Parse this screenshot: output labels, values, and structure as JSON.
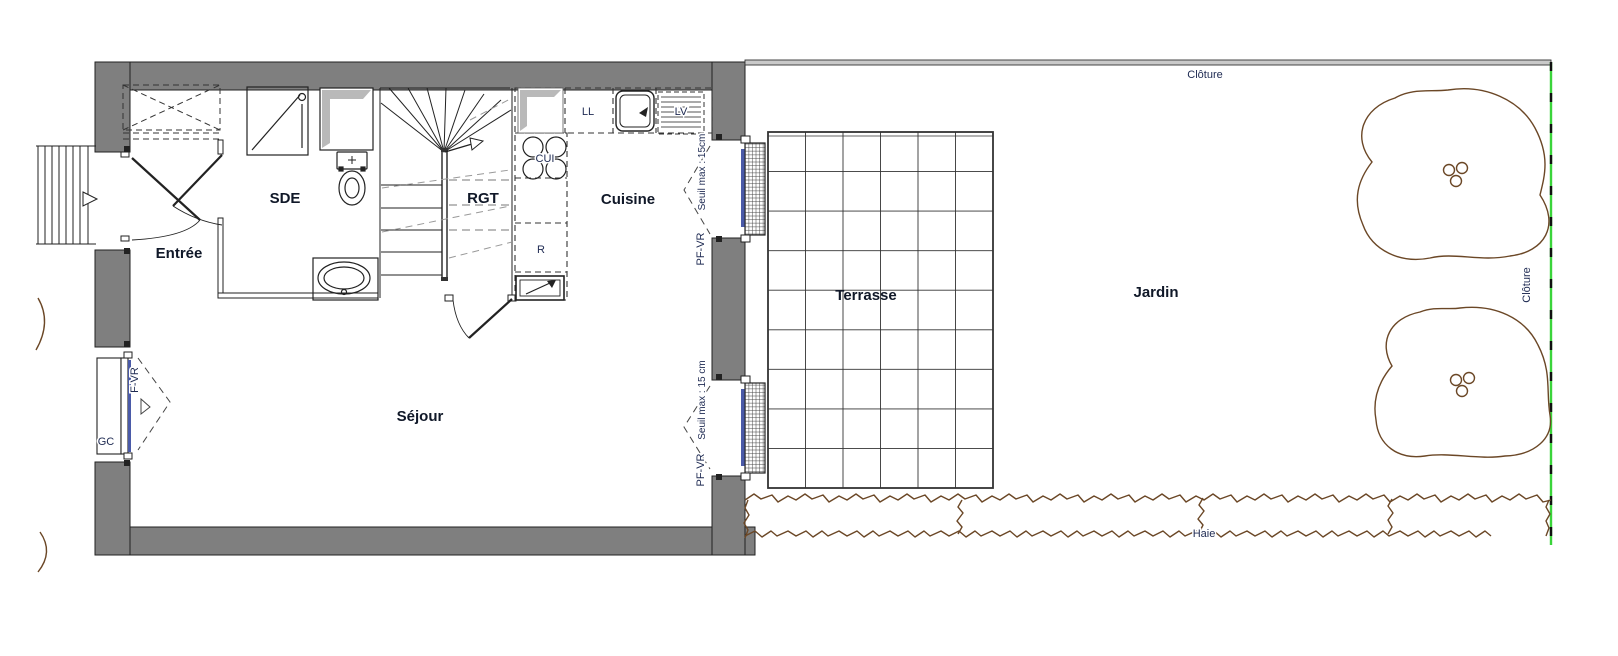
{
  "plan": {
    "rooms": {
      "sde": "SDE",
      "entree": "Entrée",
      "rgt": "RGT",
      "cuisine": "Cuisine",
      "sejour": "Séjour"
    },
    "exterior": {
      "terrasse": "Terrasse",
      "jardin": "Jardin",
      "haie": "Haie",
      "cloture_top": "Clôture",
      "cloture_right": "Clôture"
    },
    "appliances": {
      "ll": "LL",
      "lv": "LV",
      "cui": "CUI",
      "r": "R"
    },
    "openings": {
      "gc": "GC",
      "f_vr": "F-VR",
      "pf_vr_top": "PF-VR",
      "seuil_top": "Seuil max : 15cm",
      "pf_vr_bottom": "PF-VR",
      "seuil_bottom": "Seuil max : 15 cm"
    },
    "colors": {
      "wall": "#7f7f7f",
      "line": "#222222",
      "label_small": "#1e2a52",
      "label_room": "#101828",
      "vegetation": "#6b4726",
      "fence_green": "#3ad43a",
      "window_frame": "#4a5aa8"
    }
  }
}
